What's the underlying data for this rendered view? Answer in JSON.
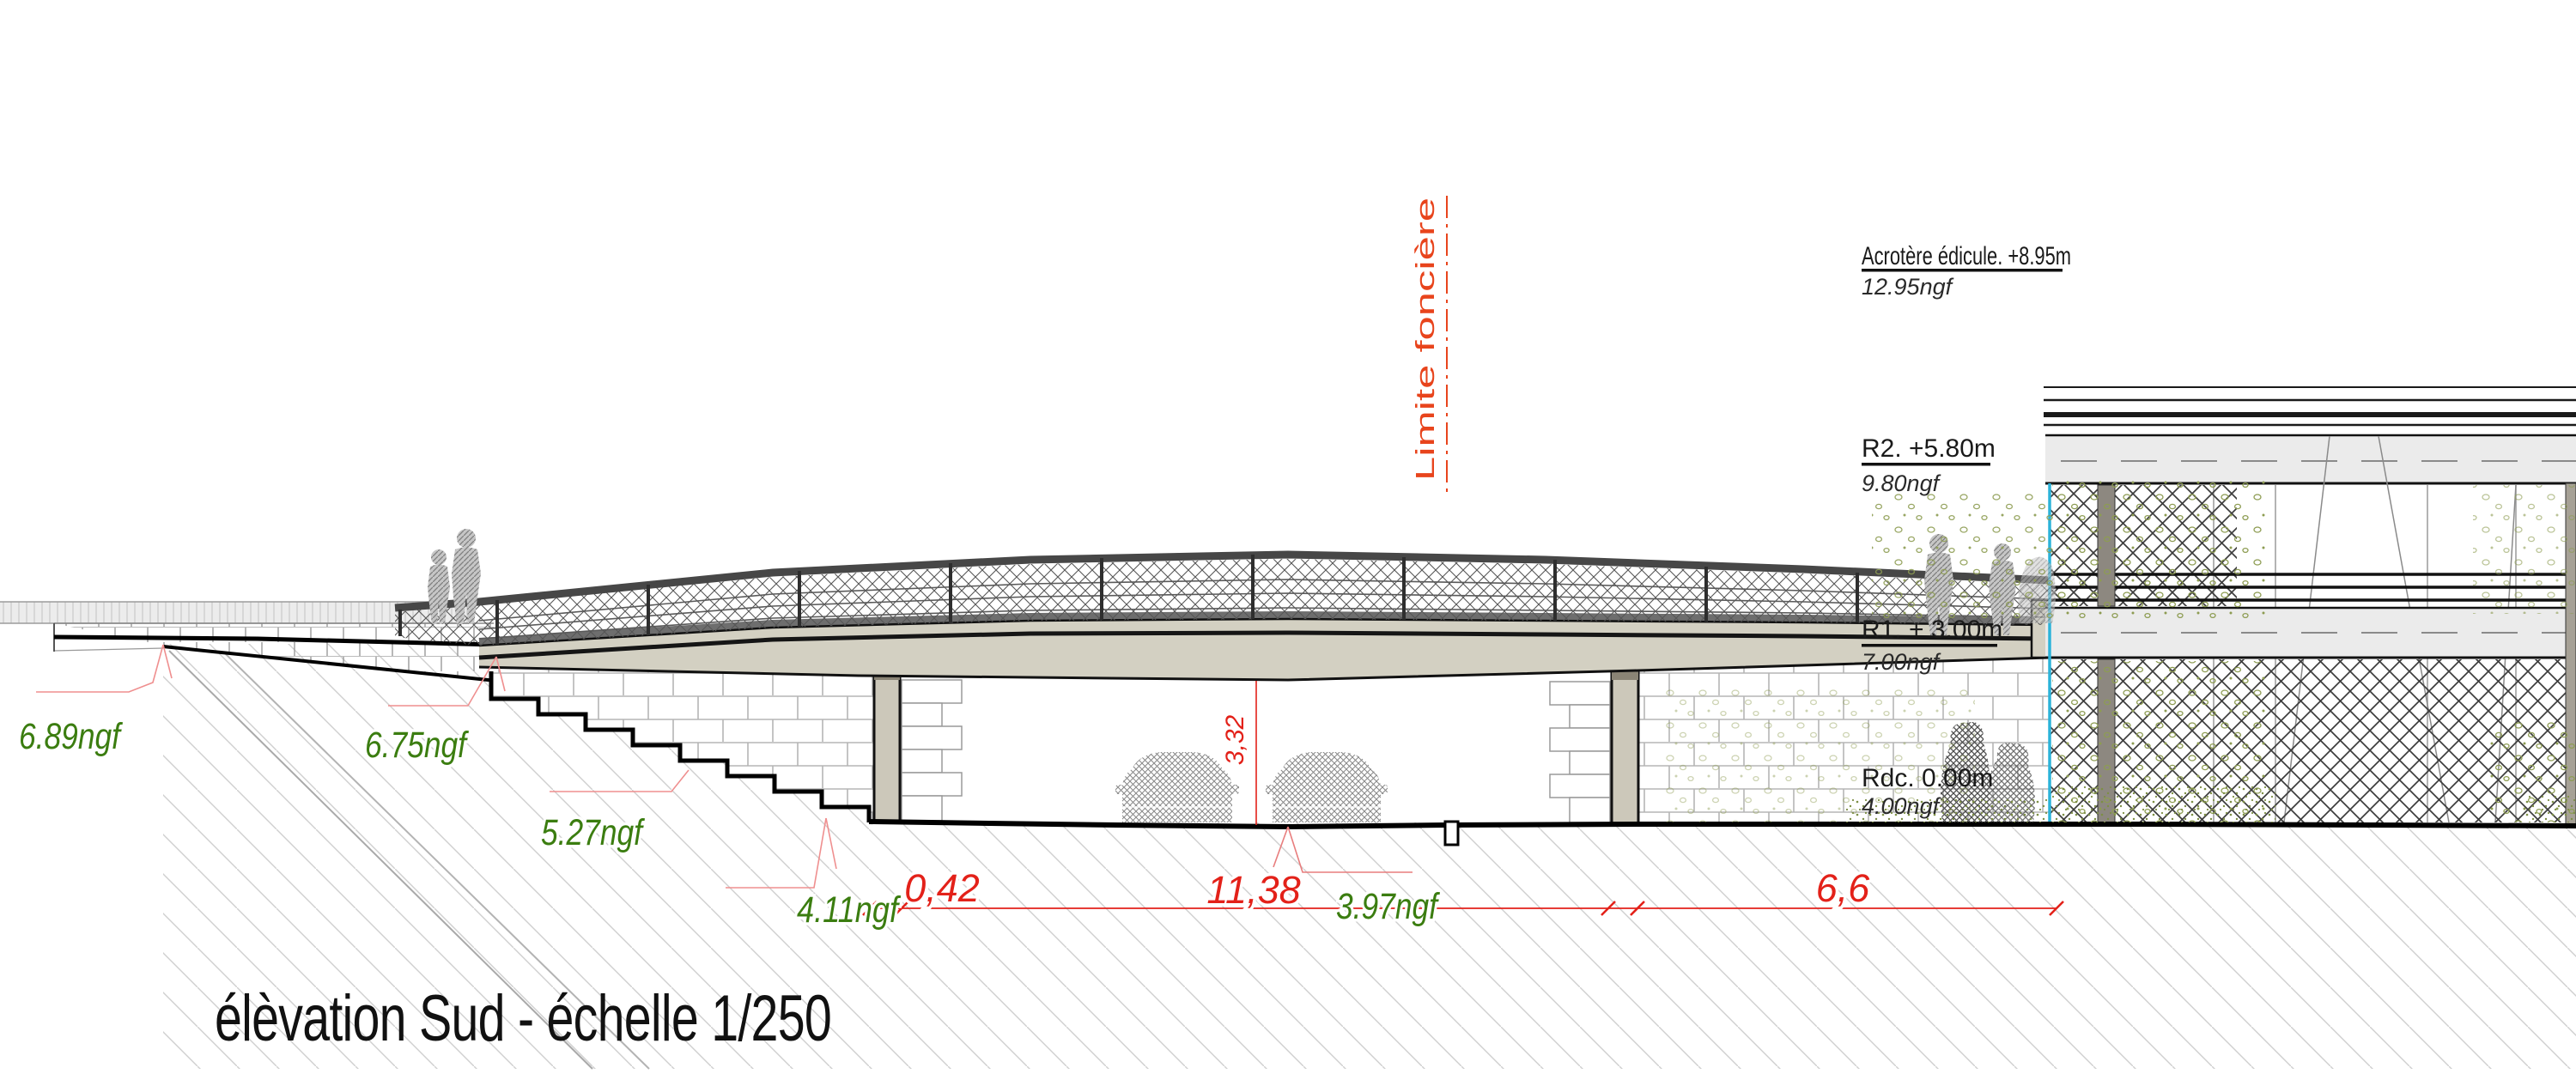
{
  "title": "élèvation Sud - échelle 1/250",
  "boundary": {
    "label": "Limite foncière",
    "color": "#e8441c"
  },
  "levels": [
    {
      "id": "acrotere",
      "label": "Acrotère édicule. +8.95m",
      "ngf": "12.95ngf"
    },
    {
      "id": "r2",
      "label": "R2. +5.80m",
      "ngf": "9.80ngf"
    },
    {
      "id": "r1",
      "label": "R1. + 3.00m",
      "ngf": "7.00ngf"
    },
    {
      "id": "rdc",
      "label": "Rdc. 0.00m",
      "ngf": "4.00ngf"
    }
  ],
  "spot_elevations": [
    {
      "label": "6.89ngf"
    },
    {
      "label": "6.75ngf"
    },
    {
      "label": "5.27ngf"
    },
    {
      "label": "4.11ngf"
    },
    {
      "label": "3.97ngf"
    }
  ],
  "dimensions": {
    "d_042": "0,42",
    "d_1138": "11,38",
    "d_66": "6,6",
    "clear_height": "3,32"
  },
  "colors": {
    "dimension_red": "#e32119",
    "elevation_green": "#3b7d10",
    "boundary_orange": "#e8441c",
    "property_line_cyan": "#2cb3d9",
    "deck_beige": "#d3d0c2",
    "leader_pink": "#ef8f8f"
  }
}
